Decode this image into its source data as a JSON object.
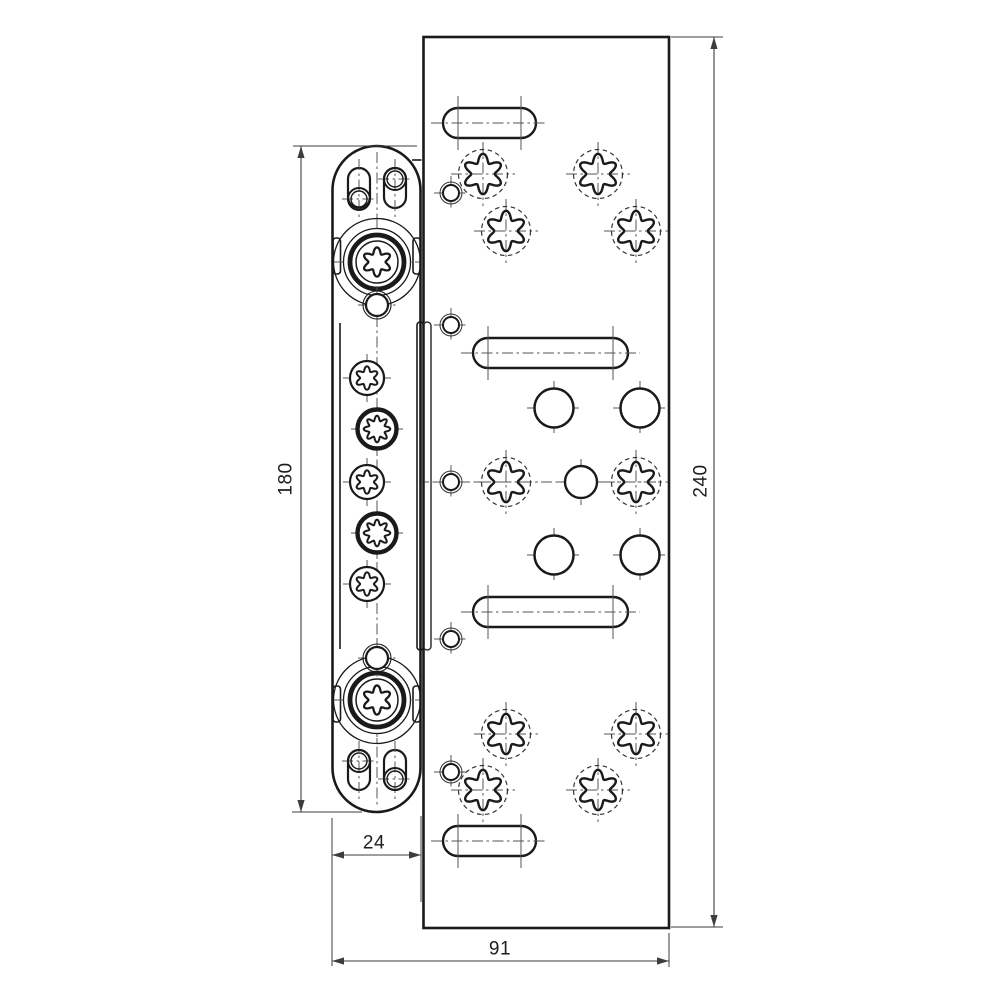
{
  "labels": {
    "dim_hinge_height": "180",
    "dim_hinge_width": "24",
    "dim_plate_height": "240",
    "dim_plate_width": "91"
  },
  "drawing": {
    "canvas": {
      "w": 1000,
      "h": 1000
    },
    "colors": {
      "line": "#1a1a1a",
      "thin": "#333333",
      "center": "#555555",
      "dim": "#3d3d3d",
      "bg": "#ffffff"
    },
    "plate": {
      "x": 423.5,
      "y": 37,
      "w": 245.5,
      "h": 891,
      "pocket": {
        "x": 423.5,
        "y": 322,
        "w": 7.5,
        "h": 328
      }
    },
    "hinge": {
      "x": 332.5,
      "y": 146,
      "w": 88,
      "h": 666,
      "corner_r": 44,
      "axis_x": 377,
      "inner_left": {
        "x": 340,
        "y1": 323,
        "y2": 649
      },
      "lamella": {
        "x": 417,
        "y": 322,
        "w": 6.5,
        "h": 328
      },
      "step": {
        "x1": 412,
        "x2": 421.5,
        "y": 160
      },
      "notch_size": [
        7.5,
        36
      ],
      "notches": [
        [
          333,
          238
        ],
        [
          413,
          238
        ],
        [
          333,
          686
        ],
        [
          413,
          686
        ]
      ]
    },
    "hinge_holes": {
      "big_screws": [
        [
          377,
          262
        ],
        [
          377,
          700
        ]
      ],
      "rings_small": [
        [
          377,
          305
        ],
        [
          377,
          658
        ]
      ],
      "torx": [
        [
          367,
          378
        ],
        [
          367,
          482
        ],
        [
          367,
          584
        ]
      ],
      "star8": [
        [
          377,
          429
        ],
        [
          377,
          533
        ]
      ],
      "slots": [
        {
          "x": 348,
          "y": 168,
          "w": 22,
          "h": 40,
          "circle": [
            359,
            199
          ]
        },
        {
          "x": 384,
          "y": 168,
          "w": 22,
          "h": 40,
          "circle": [
            395,
            179
          ]
        },
        {
          "x": 348,
          "y": 750,
          "w": 22,
          "h": 40,
          "circle": [
            359,
            761
          ]
        },
        {
          "x": 384,
          "y": 750,
          "w": 22,
          "h": 40,
          "circle": [
            395,
            779
          ]
        }
      ]
    },
    "plate_holes": {
      "torx": [
        [
          483,
          174
        ],
        [
          598,
          174
        ],
        [
          506,
          231
        ],
        [
          636,
          231
        ],
        [
          506,
          482
        ],
        [
          636,
          482
        ],
        [
          506,
          734
        ],
        [
          636,
          734
        ],
        [
          483,
          790
        ],
        [
          598,
          790
        ]
      ],
      "small": [
        [
          451,
          193
        ],
        [
          451,
          325
        ],
        [
          451,
          482
        ],
        [
          451,
          639
        ],
        [
          451,
          772
        ]
      ],
      "medium": [
        [
          554,
          408
        ],
        [
          640,
          408
        ],
        [
          554,
          555
        ],
        [
          640,
          555
        ]
      ],
      "center_circle": [
        581,
        482
      ],
      "slots": [
        {
          "x": 443,
          "y": 108,
          "w": 93,
          "h": 30
        },
        {
          "x": 473,
          "y": 338,
          "w": 155,
          "h": 30
        },
        {
          "x": 473,
          "y": 597,
          "w": 155,
          "h": 30
        },
        {
          "x": 443,
          "y": 826,
          "w": 93,
          "h": 30
        }
      ],
      "row_centerline": {
        "y": 482,
        "x1": 336,
        "x2": 662
      }
    },
    "dims": {
      "d180": {
        "orient": "v",
        "line": [
          301,
          146,
          301,
          812
        ],
        "ext": [
          [
            293,
            146,
            417,
            146
          ],
          [
            292,
            812,
            362,
            812
          ]
        ]
      },
      "d24": {
        "orient": "h",
        "line": [
          332,
          855,
          421,
          855
        ],
        "ext": [
          [
            332,
            818,
            332,
            966
          ],
          [
            421,
            816,
            421,
            902
          ]
        ]
      },
      "d91": {
        "orient": "h",
        "line": [
          332,
          961,
          669,
          961
        ],
        "ext": [
          [
            669,
            933,
            669,
            967
          ]
        ]
      },
      "d240": {
        "orient": "v",
        "line": [
          714,
          37,
          714,
          927
        ],
        "ext": [
          [
            671,
            37,
            723,
            37
          ],
          [
            671,
            927,
            723,
            927
          ]
        ]
      }
    }
  }
}
